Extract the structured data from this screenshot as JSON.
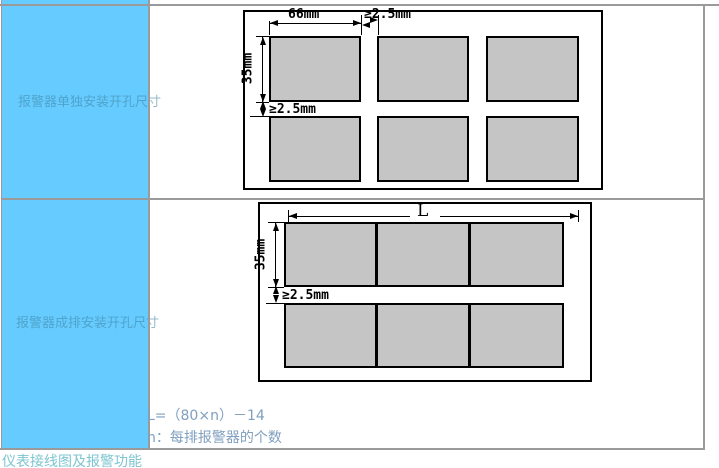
{
  "table": {
    "rows": [
      {
        "label": "报警器单独安装开孔尺寸",
        "diagram": {
          "width_dim": "66mm",
          "h_gap_dim": "≥2.5mm",
          "height_dim": "35mm",
          "v_gap_dim": "≥2.5mm"
        }
      },
      {
        "label": "报警器成排安装开孔尺寸",
        "diagram": {
          "length_dim": "L",
          "height_dim": "35mm",
          "v_gap_dim": "≥2.5mm"
        },
        "formula_line1": "L=（80×n）－14",
        "formula_line2": "n：每排报警器的个数"
      }
    ]
  },
  "footer": {
    "label": "仪表接线图及报警功能"
  },
  "colors": {
    "row_header_bg": "#66ccff",
    "cutout_fill": "#c5c5c5",
    "formula_text": "#7f9fbe",
    "footer_text": "#7cc5d1"
  }
}
